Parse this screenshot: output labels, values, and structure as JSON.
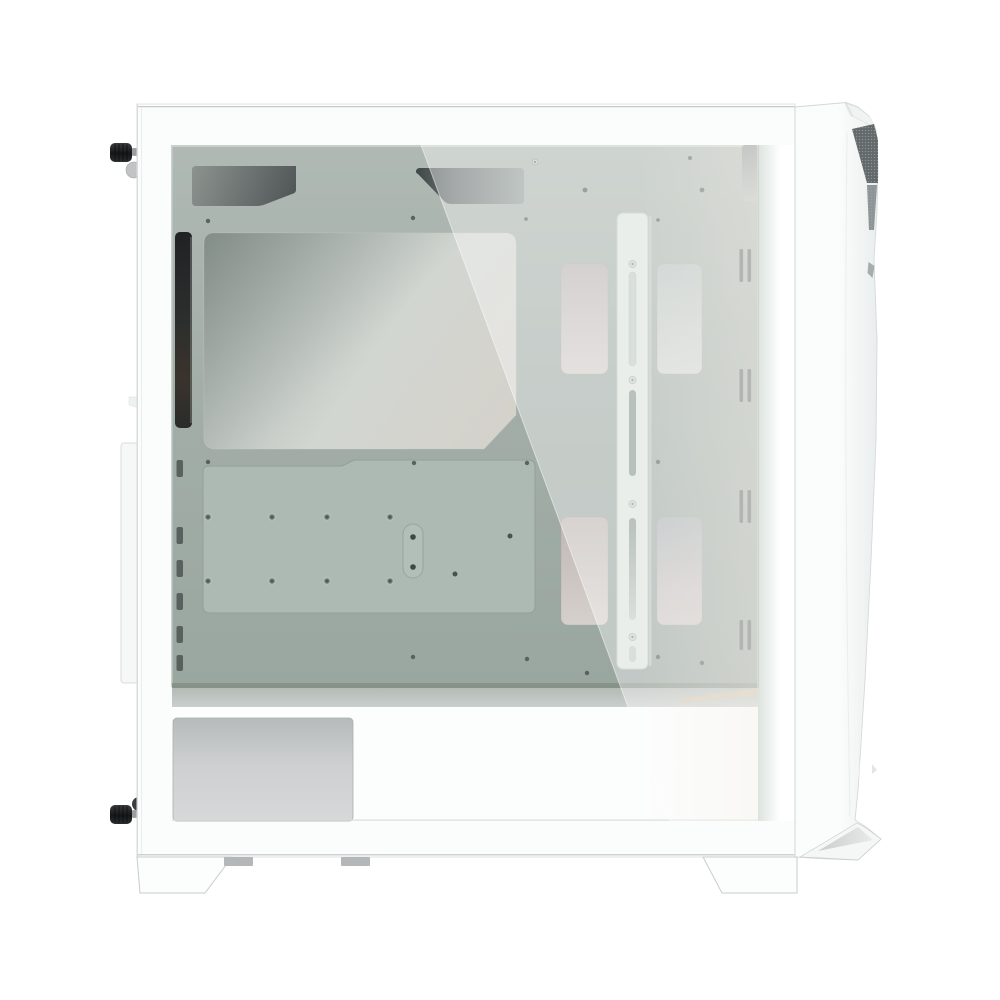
{
  "scene": {
    "subject": "white-mid-tower-pc-case-left-side-tempered-glass-view",
    "background": "#ffffff",
    "parts": [
      "tempered-glass-side-panel",
      "motherboard-tray",
      "cpu-cooler-cutout",
      "cable-routing-cutouts",
      "fan-radiator-rail",
      "drive-tray-windows",
      "front-vent-slots",
      "psu-shroud",
      "psu-side-plate",
      "rear-thumbscrews",
      "rear-expansion-bulge",
      "front-bezel-with-mesh-accent",
      "case-feet"
    ]
  },
  "colors": {
    "background": "#ffffff",
    "case_white": "#fbfcfc",
    "top_line": "#c7cbcb",
    "bottom_line": "#ced2d2",
    "tray_green": "#a3aea8",
    "tray_edge_dark": "#879289",
    "shroud_white": "#fcfdfd",
    "cutout_dark": "#4e5455",
    "rail_white": "#dde5e0",
    "vent_dark": "#5a6561",
    "rear_strip_black": "#27292a",
    "knob_black": "#1c1e1f",
    "tan_accent": "#cfc4ac",
    "mesh_gray": "#636a6b",
    "mesh_dot": "#aab0b0",
    "reflection": "rgba(252,253,252,0.40)",
    "foot_white": "#fcfdfd",
    "foot_line": "#c9cdcd",
    "tab_gray": "#b3b7b7",
    "screw_dark": "#515a57",
    "plate_white": "#f6f8f8",
    "inner_wall_line": "#cbd2ce",
    "bezel_line": "#d9dddd"
  }
}
